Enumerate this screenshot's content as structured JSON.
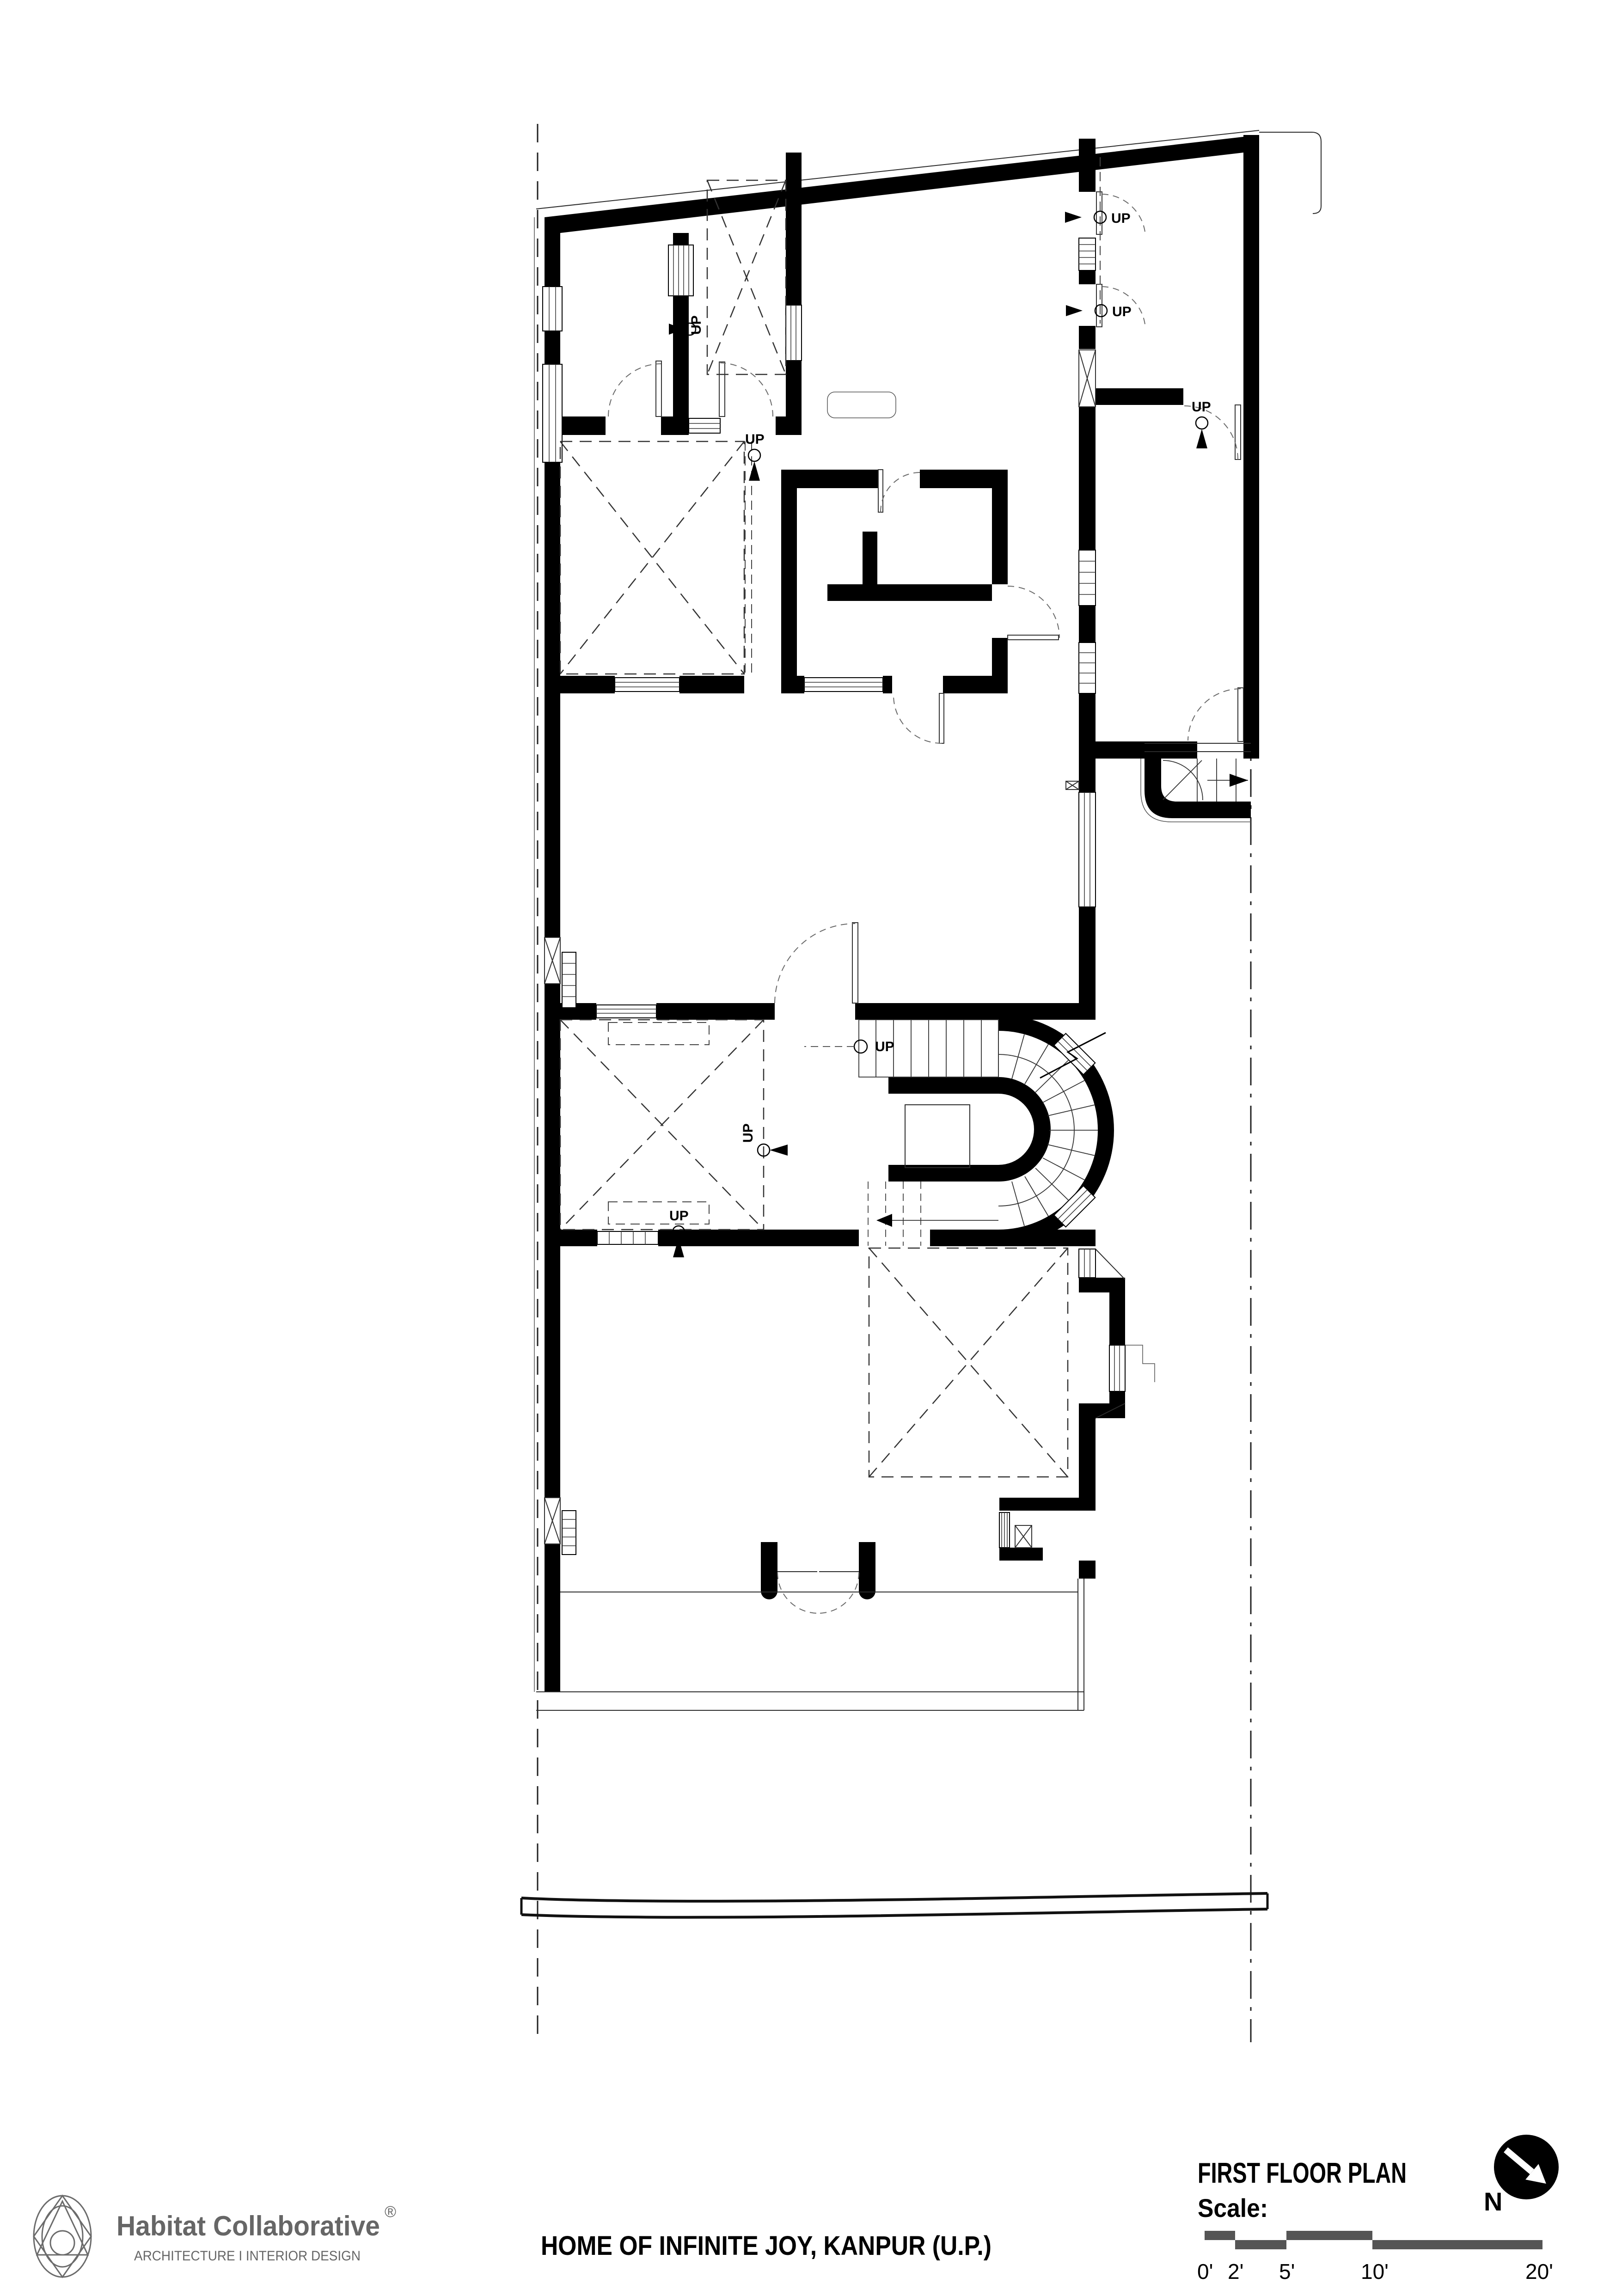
{
  "drawing": {
    "title": "FIRST FLOOR PLAN",
    "scale_label": "Scale:",
    "scale_ticks": [
      "0'",
      "2'",
      "5'",
      "10'",
      "20'"
    ],
    "north_label": "N"
  },
  "project": {
    "title": "HOME OF INFINITE JOY, KANPUR (U.P.)"
  },
  "firm": {
    "name": "Habitat Collaborative",
    "registered_mark": "®",
    "tagline": "ARCHITECTURE I INTERIOR DESIGN"
  },
  "plan": {
    "up_label": "UP"
  },
  "colors": {
    "walls": "#000000",
    "thin_lines": "#2b2b2b",
    "scale_bar": "#555555",
    "logo_gray": "#6b6b6b"
  }
}
